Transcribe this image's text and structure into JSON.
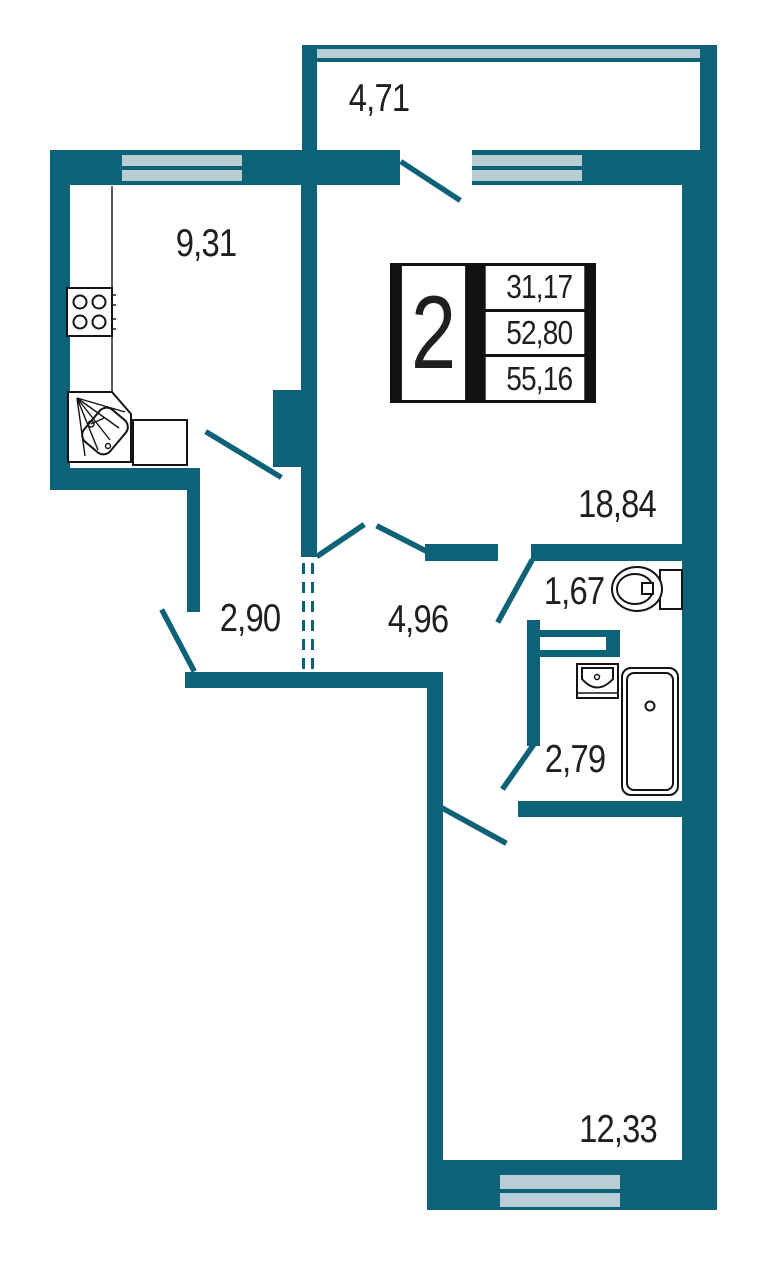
{
  "plan": {
    "legend": {
      "rooms_count": "2",
      "living_area": "31,17",
      "apartment_area": "52,80",
      "total_area": "55,16"
    },
    "areas": {
      "balcony": "4,71",
      "kitchen": "9,31",
      "living_room": "18,84",
      "hallway": "2,90",
      "corridor": "4,96",
      "toilet": "1,67",
      "bathroom": "2,79",
      "bedroom": "12,33"
    },
    "colors": {
      "wall": "#0d6277",
      "window": "#b9cdd4",
      "fixture_line": "#141414",
      "text": "#1f1f1f",
      "background": "#ffffff"
    },
    "fixtures": [
      "stove",
      "kitchen-sink",
      "kitchen-counter",
      "toilet",
      "washbasin",
      "bathtub"
    ]
  }
}
